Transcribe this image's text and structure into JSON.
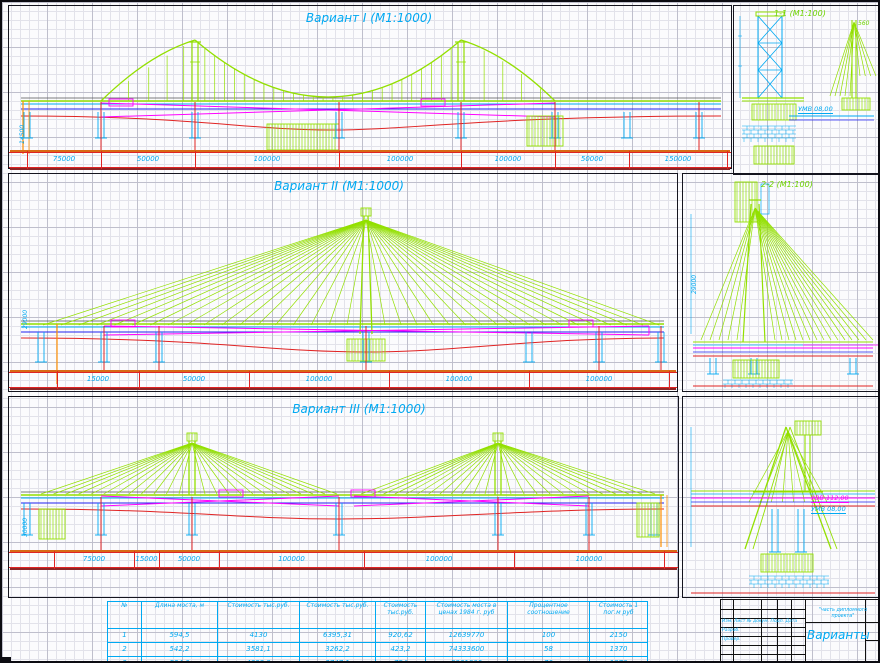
{
  "titles": {
    "v1": "Вариант I (М1:1000)",
    "v2": "Вариант II (М1:1000)",
    "v3": "Вариант III (М1:1000)",
    "s1": "1-1 (М1:100)",
    "s2": "2-2 (М1:100)"
  },
  "levels": {
    "umv": "УМВ 08,00",
    "uvv": "УВВ 112,00",
    "s1_dim": "560"
  },
  "vdims": {
    "p1": "14500",
    "p2": "29000",
    "p3": "30000"
  },
  "dims": {
    "v1": [
      "75000",
      "50000",
      "100000",
      "100000",
      "100000",
      "50000",
      "150000"
    ],
    "v2": [
      "15000",
      "50000",
      "100000",
      "100000",
      "100000"
    ],
    "v3": [
      "75000",
      "15000",
      "50000",
      "100000",
      "100000",
      "100000"
    ]
  },
  "table": {
    "headers": [
      "№",
      "Длина моста, м",
      "Стоимость тыс.руб.",
      "Стоимость тыс.руб.",
      "Стоимость тыс.руб.",
      "Стоимость моста в ценах 1984 г. руб",
      "Процентное соотношение",
      "Стоимость 1 пог.м руб"
    ],
    "rows": [
      [
        "1",
        "594,5",
        "4130",
        "6395,31",
        "920,62",
        "12639770",
        "100",
        "2150"
      ],
      [
        "2",
        "542,2",
        "3581,1",
        "3262,2",
        "423,2",
        "74333600",
        "58",
        "1370"
      ],
      [
        "3",
        "534,6",
        "4322,9",
        "3747,1",
        "754",
        "8961800",
        "70",
        "1870"
      ]
    ]
  },
  "stamp": {
    "row_labels": "Изм. Лист № докум. Подп. Дата",
    "dev": "Разраб.",
    "check": "Провер.",
    "doc_note": "\"часть дипломного проекта\"",
    "sheet_title": "Варианты"
  },
  "colors": {
    "cyan": "#00a9f2",
    "green": "#93e000",
    "magenta": "#ff00ff",
    "red": "#e02323",
    "blue": "#2222ee",
    "orange": "#ff9000",
    "dark": "#555555"
  }
}
